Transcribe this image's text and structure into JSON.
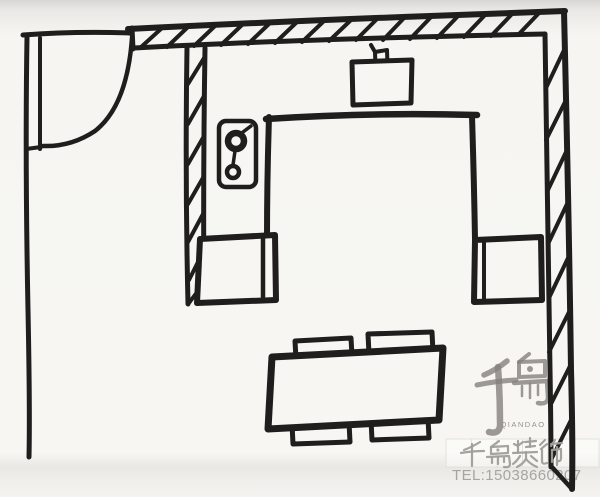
{
  "canvas": {
    "width": 600,
    "height": 497
  },
  "palette": {
    "paper": "#f7f6f3",
    "ink": "#1f1e1d",
    "watermark_logo_gray": "#83817d",
    "watermark_text_gray": "#a19e9a",
    "watermark_tel_gray": "#a8a5a1"
  },
  "sketch": {
    "description": "hand-drawn floor plan",
    "elements": {
      "door": "swing arc at top-left opening",
      "walls": "hatched outer walls (top, right) and interior partition",
      "fixtures": "sink symbol on top wall, stove symbol on partition wall",
      "furniture": "two side cabinets, dining table with four chairs"
    }
  },
  "watermark": {
    "logo_main": "千岛",
    "logo_sub": "QIANDAO",
    "brand": "千岛装饰",
    "tel": "TEL:15038660207"
  }
}
